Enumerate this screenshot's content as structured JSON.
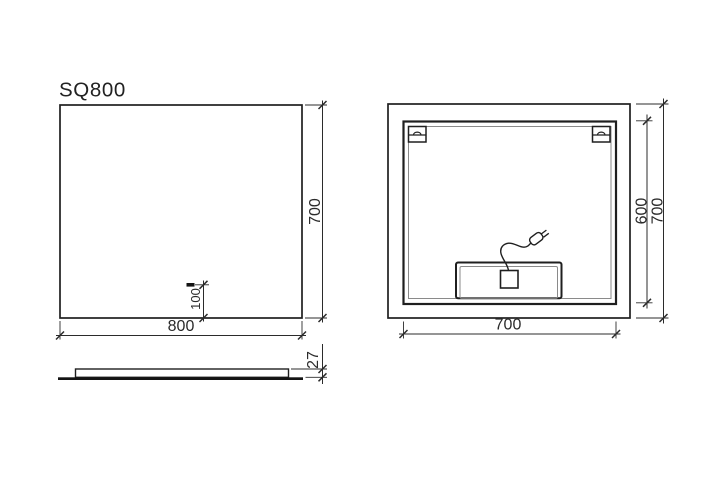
{
  "drawing": {
    "title": "SQ800",
    "front_view": {
      "width": "800",
      "height": "700",
      "sensor_offset": "100"
    },
    "side_view": {
      "thickness": "27"
    },
    "back_view": {
      "frame_width": "700",
      "frame_height": "600",
      "mirror_height": "700"
    },
    "colors": {
      "line": "#1f1f1f",
      "dimension_line": "#2b2b2b",
      "thin_line": "#8a8a8a",
      "background": "#ffffff"
    }
  }
}
